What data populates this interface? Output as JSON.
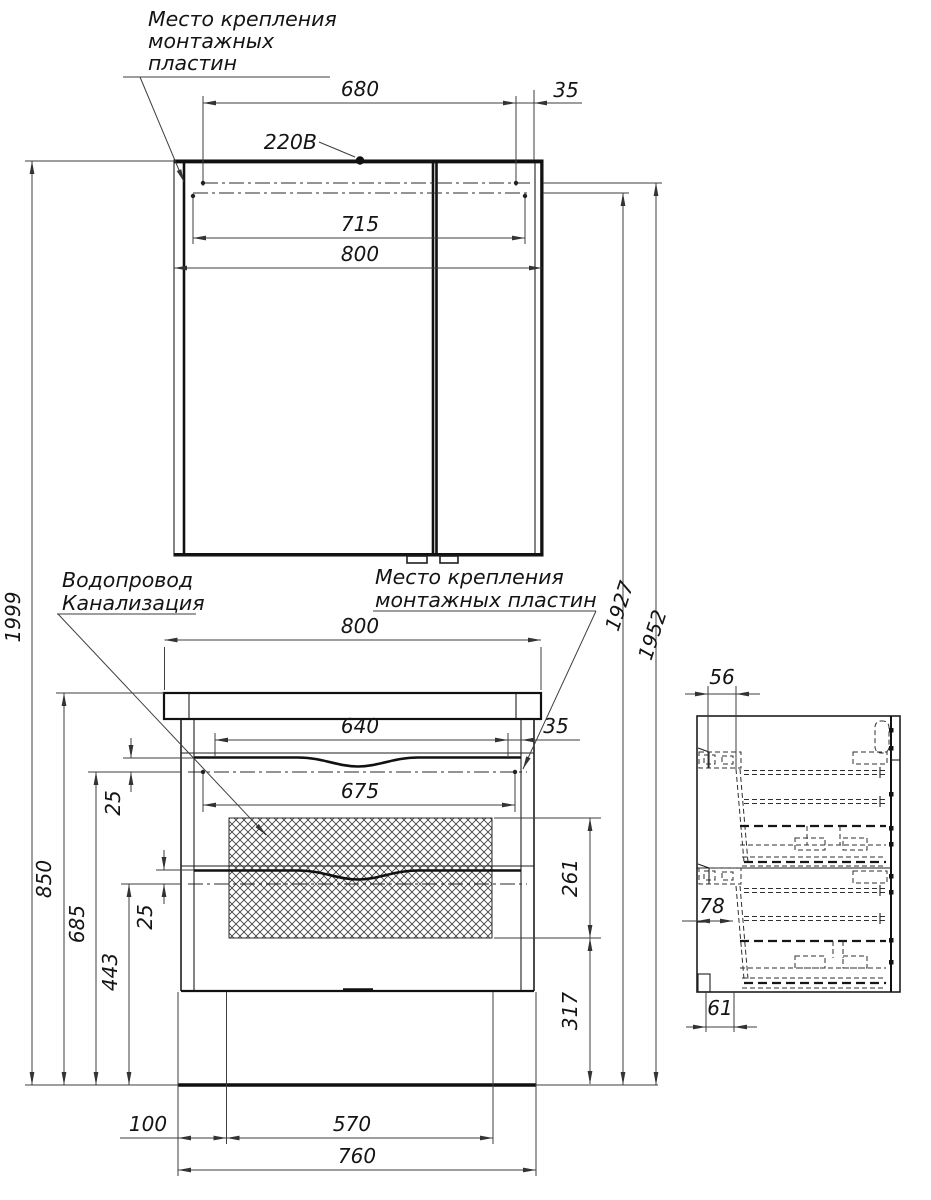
{
  "labels": {
    "mounting_plates_top": [
      "Место крепления",
      "монтажных",
      "пластин"
    ],
    "power_supply": "220В",
    "plumbing": [
      "Водопровод",
      "Канализация"
    ],
    "mounting_plates_vanity": [
      "Место крепления",
      "монтажных пластин"
    ]
  },
  "dimensions_mm": {
    "mirror": {
      "plate_span": "680",
      "plate_offset": "35",
      "inner_width": "715",
      "width": "800"
    },
    "heights": {
      "total": "1999",
      "to_plate_upper": "1952",
      "to_plate_lower": "1927",
      "to_countertop": "850",
      "to_plate_1": "685",
      "to_plate_2": "443",
      "plate_offset_1": "25",
      "plate_offset_2": "25"
    },
    "vanity": {
      "width": "800",
      "drawer_span": "640",
      "plate_offset": "35",
      "plate_span": "675",
      "hatch_height": "261",
      "hatch_to_floor": "317",
      "base_left": "100",
      "base_span": "570",
      "base_width": "760"
    },
    "side": {
      "depth_top": "56",
      "front_offset": "78",
      "bottom_offset": "61"
    }
  }
}
